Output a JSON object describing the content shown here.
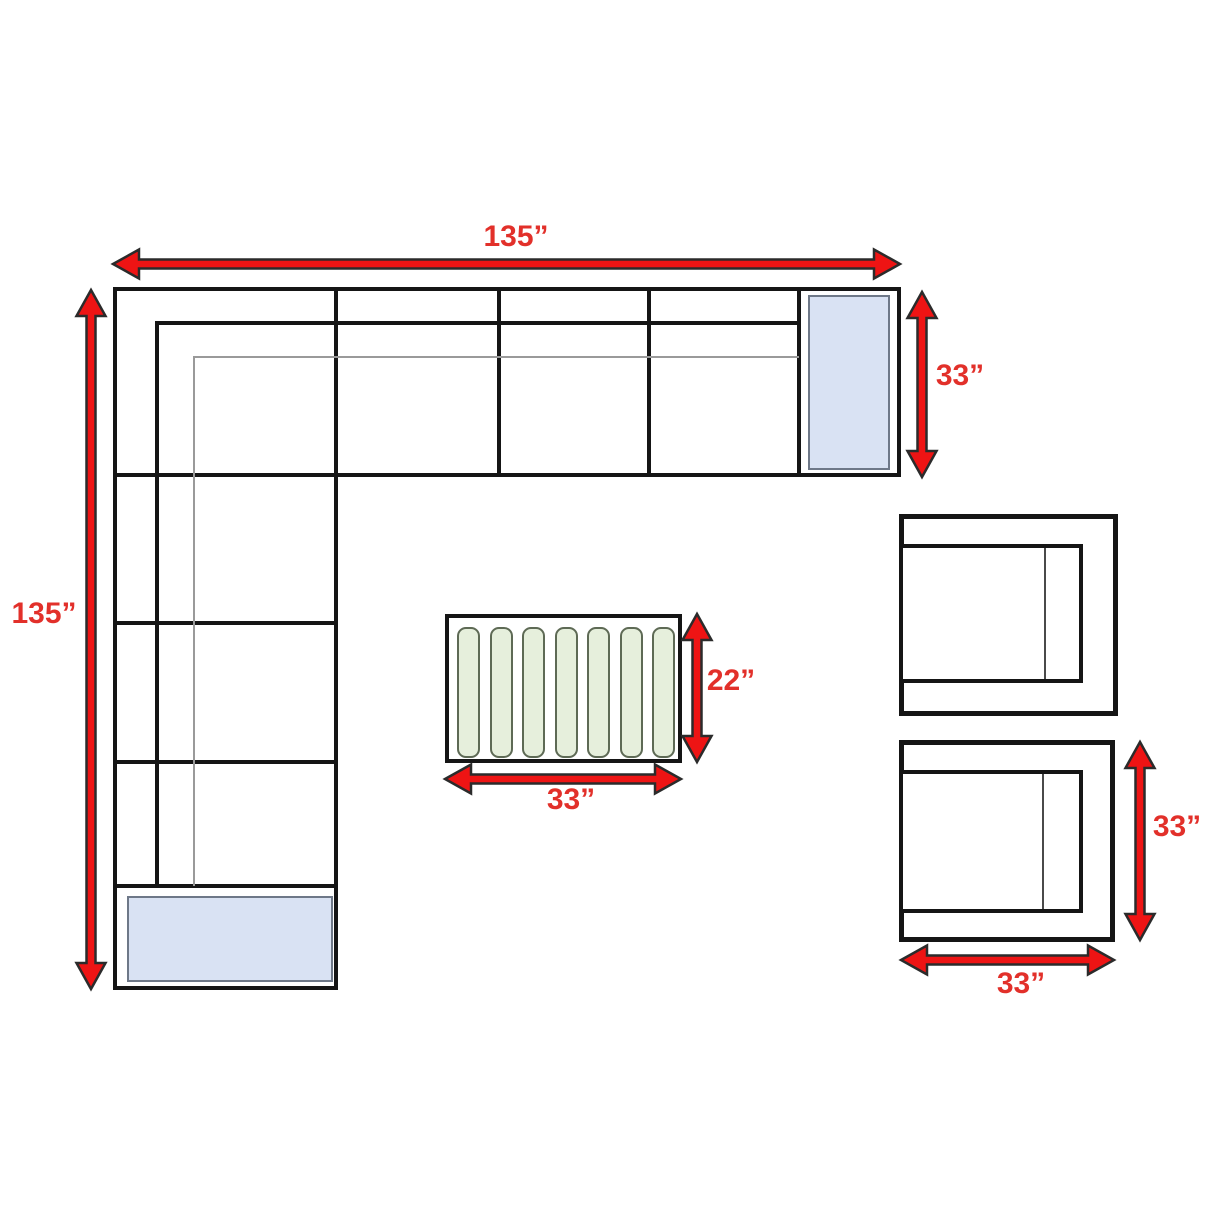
{
  "diagram": {
    "type": "furniture-dimension-floor-plan",
    "background": "#ffffff"
  },
  "colors": {
    "arrow_fill": "#ee1414",
    "arrow_outline": "#2b2b2b",
    "label_red": "#e2302a",
    "line_black": "#151515",
    "line_gray": "#9a9a9a",
    "end_table_fill": "#d9e2f3",
    "end_table_border": "#6e7888",
    "slat_fill": "#e6efdc",
    "slat_border": "#5e6a55"
  },
  "sofa": {
    "name": "L-shaped sectional sofa",
    "width_label": "135”",
    "depth_label": "135”",
    "end_section_label": "33”"
  },
  "coffee_table": {
    "name": "slatted coffee table",
    "slat_count": 7,
    "depth_label": "22”",
    "width_label": "33”"
  },
  "armchairs": {
    "count": 2,
    "depth_label": "33”",
    "width_label": "33”"
  }
}
